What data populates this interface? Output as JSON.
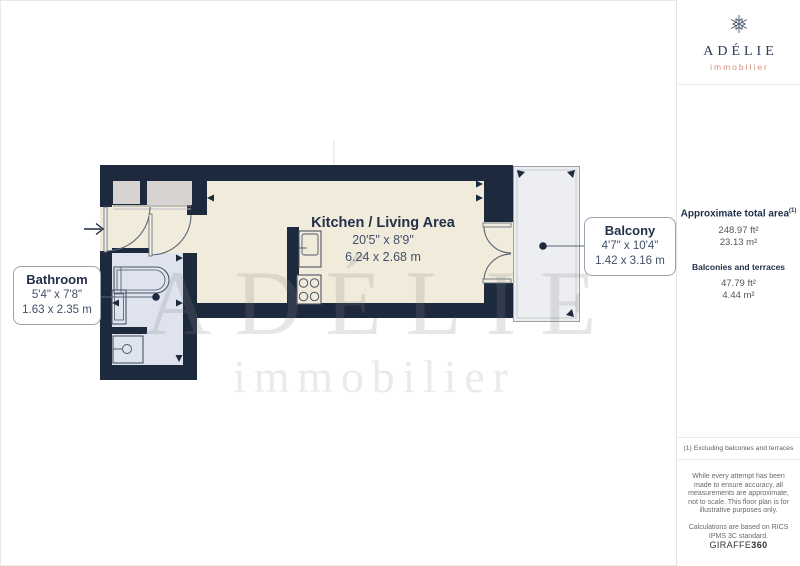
{
  "brand": {
    "name": "ADÉLIE",
    "tagline": "immobilier"
  },
  "watermark": {
    "name": "ADÉLIE",
    "tagline": "immobilier"
  },
  "rooms": {
    "kitchen_living": {
      "name": "Kitchen / Living Area",
      "imperial": "20'5\" x 8'9\"",
      "metric": "6.24 x 2.68 m"
    },
    "bathroom": {
      "name": "Bathroom",
      "imperial": "5'4\" x 7'8\"",
      "metric": "1.63 x 2.35 m"
    },
    "balcony": {
      "name": "Balcony",
      "imperial": "4'7\" x 10'4\"",
      "metric": "1.42 x 3.16 m"
    }
  },
  "sidebar": {
    "total_area": {
      "label": "Approximate total area",
      "marker": "(1)",
      "imperial": "248.97 ft²",
      "metric": "23.13 m²"
    },
    "balconies": {
      "label": "Balconies and terraces",
      "imperial": "47.79 ft²",
      "metric": "4.44 m²"
    },
    "footnote": "(1) Excluding balconies and terraces",
    "disclaimer": "While every attempt has been made to ensure accuracy, all measurements are approximate, not to scale. This floor plan is for illustrative purposes only.",
    "standard": "Calculations are based on RICS IPMS 3C standard.",
    "provider": {
      "name": "GIRAFFE",
      "suffix": "360"
    }
  },
  "colors": {
    "wall": "#1d2a3e",
    "floor": "#f1ebdb",
    "bathroom_floor": "#dee3ee",
    "closet": "#d6d3d0",
    "balcony": "#eceef1",
    "brand_navy": "#2c3c59",
    "brand_salmon": "#d78d80",
    "label_navy": "#22304a"
  }
}
